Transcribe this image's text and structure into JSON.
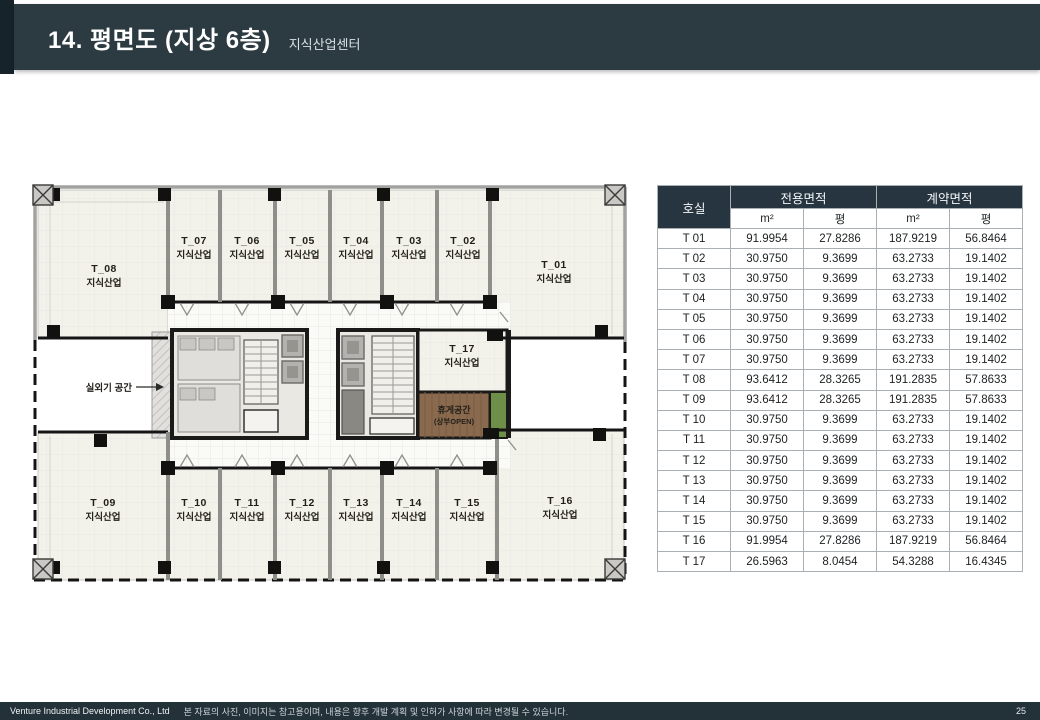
{
  "header": {
    "title": "14. 평면도 (지상 6층)",
    "subtitle": "지식산업센터"
  },
  "plan": {
    "units": [
      {
        "id": "T_01",
        "type": "지식산업"
      },
      {
        "id": "T_02",
        "type": "지식산업"
      },
      {
        "id": "T_03",
        "type": "지식산업"
      },
      {
        "id": "T_04",
        "type": "지식산업"
      },
      {
        "id": "T_05",
        "type": "지식산업"
      },
      {
        "id": "T_06",
        "type": "지식산업"
      },
      {
        "id": "T_07",
        "type": "지식산업"
      },
      {
        "id": "T_08",
        "type": "지식산업"
      },
      {
        "id": "T_09",
        "type": "지식산업"
      },
      {
        "id": "T_10",
        "type": "지식산업"
      },
      {
        "id": "T_11",
        "type": "지식산업"
      },
      {
        "id": "T_12",
        "type": "지식산업"
      },
      {
        "id": "T_13",
        "type": "지식산업"
      },
      {
        "id": "T_14",
        "type": "지식산업"
      },
      {
        "id": "T_15",
        "type": "지식산업"
      },
      {
        "id": "T_16",
        "type": "지식산업"
      },
      {
        "id": "T_17",
        "type": "지식산업"
      }
    ],
    "rest_area": {
      "line1": "휴게공간",
      "line2": "(상부OPEN)"
    },
    "outdoor_label": "실외기 공간"
  },
  "table": {
    "col_room": "호실",
    "col_exclusive": "전용면적",
    "col_contract": "계약면적",
    "unit_m2": "m²",
    "unit_pyeong": "평",
    "rows": [
      [
        "T 01",
        "91.9954",
        "27.8286",
        "187.9219",
        "56.8464"
      ],
      [
        "T 02",
        "30.9750",
        "9.3699",
        "63.2733",
        "19.1402"
      ],
      [
        "T 03",
        "30.9750",
        "9.3699",
        "63.2733",
        "19.1402"
      ],
      [
        "T 04",
        "30.9750",
        "9.3699",
        "63.2733",
        "19.1402"
      ],
      [
        "T 05",
        "30.9750",
        "9.3699",
        "63.2733",
        "19.1402"
      ],
      [
        "T 06",
        "30.9750",
        "9.3699",
        "63.2733",
        "19.1402"
      ],
      [
        "T 07",
        "30.9750",
        "9.3699",
        "63.2733",
        "19.1402"
      ],
      [
        "T 08",
        "93.6412",
        "28.3265",
        "191.2835",
        "57.8633"
      ],
      [
        "T 09",
        "93.6412",
        "28.3265",
        "191.2835",
        "57.8633"
      ],
      [
        "T 10",
        "30.9750",
        "9.3699",
        "63.2733",
        "19.1402"
      ],
      [
        "T 11",
        "30.9750",
        "9.3699",
        "63.2733",
        "19.1402"
      ],
      [
        "T 12",
        "30.9750",
        "9.3699",
        "63.2733",
        "19.1402"
      ],
      [
        "T 13",
        "30.9750",
        "9.3699",
        "63.2733",
        "19.1402"
      ],
      [
        "T 14",
        "30.9750",
        "9.3699",
        "63.2733",
        "19.1402"
      ],
      [
        "T 15",
        "30.9750",
        "9.3699",
        "63.2733",
        "19.1402"
      ],
      [
        "T 16",
        "91.9954",
        "27.8286",
        "187.9219",
        "56.8464"
      ],
      [
        "T 17",
        "26.5963",
        "8.0454",
        "54.3288",
        "16.4345"
      ]
    ]
  },
  "footer": {
    "company": "Venture Industrial Development Co., Ltd",
    "disclaimer": "본 자료의 사진, 이미지는 참고용이며, 내용은 향후 개발 계획 및 인허가 사항에 따라 변경될 수 있습니다.",
    "page": "25"
  },
  "colors": {
    "header_bar": "#2c3a42",
    "header_accent": "#17232b",
    "table_header": "#273540",
    "footer_bar": "#233139",
    "wood_floor": "#8a6a4e",
    "plant_strip": "#6d8f49"
  }
}
